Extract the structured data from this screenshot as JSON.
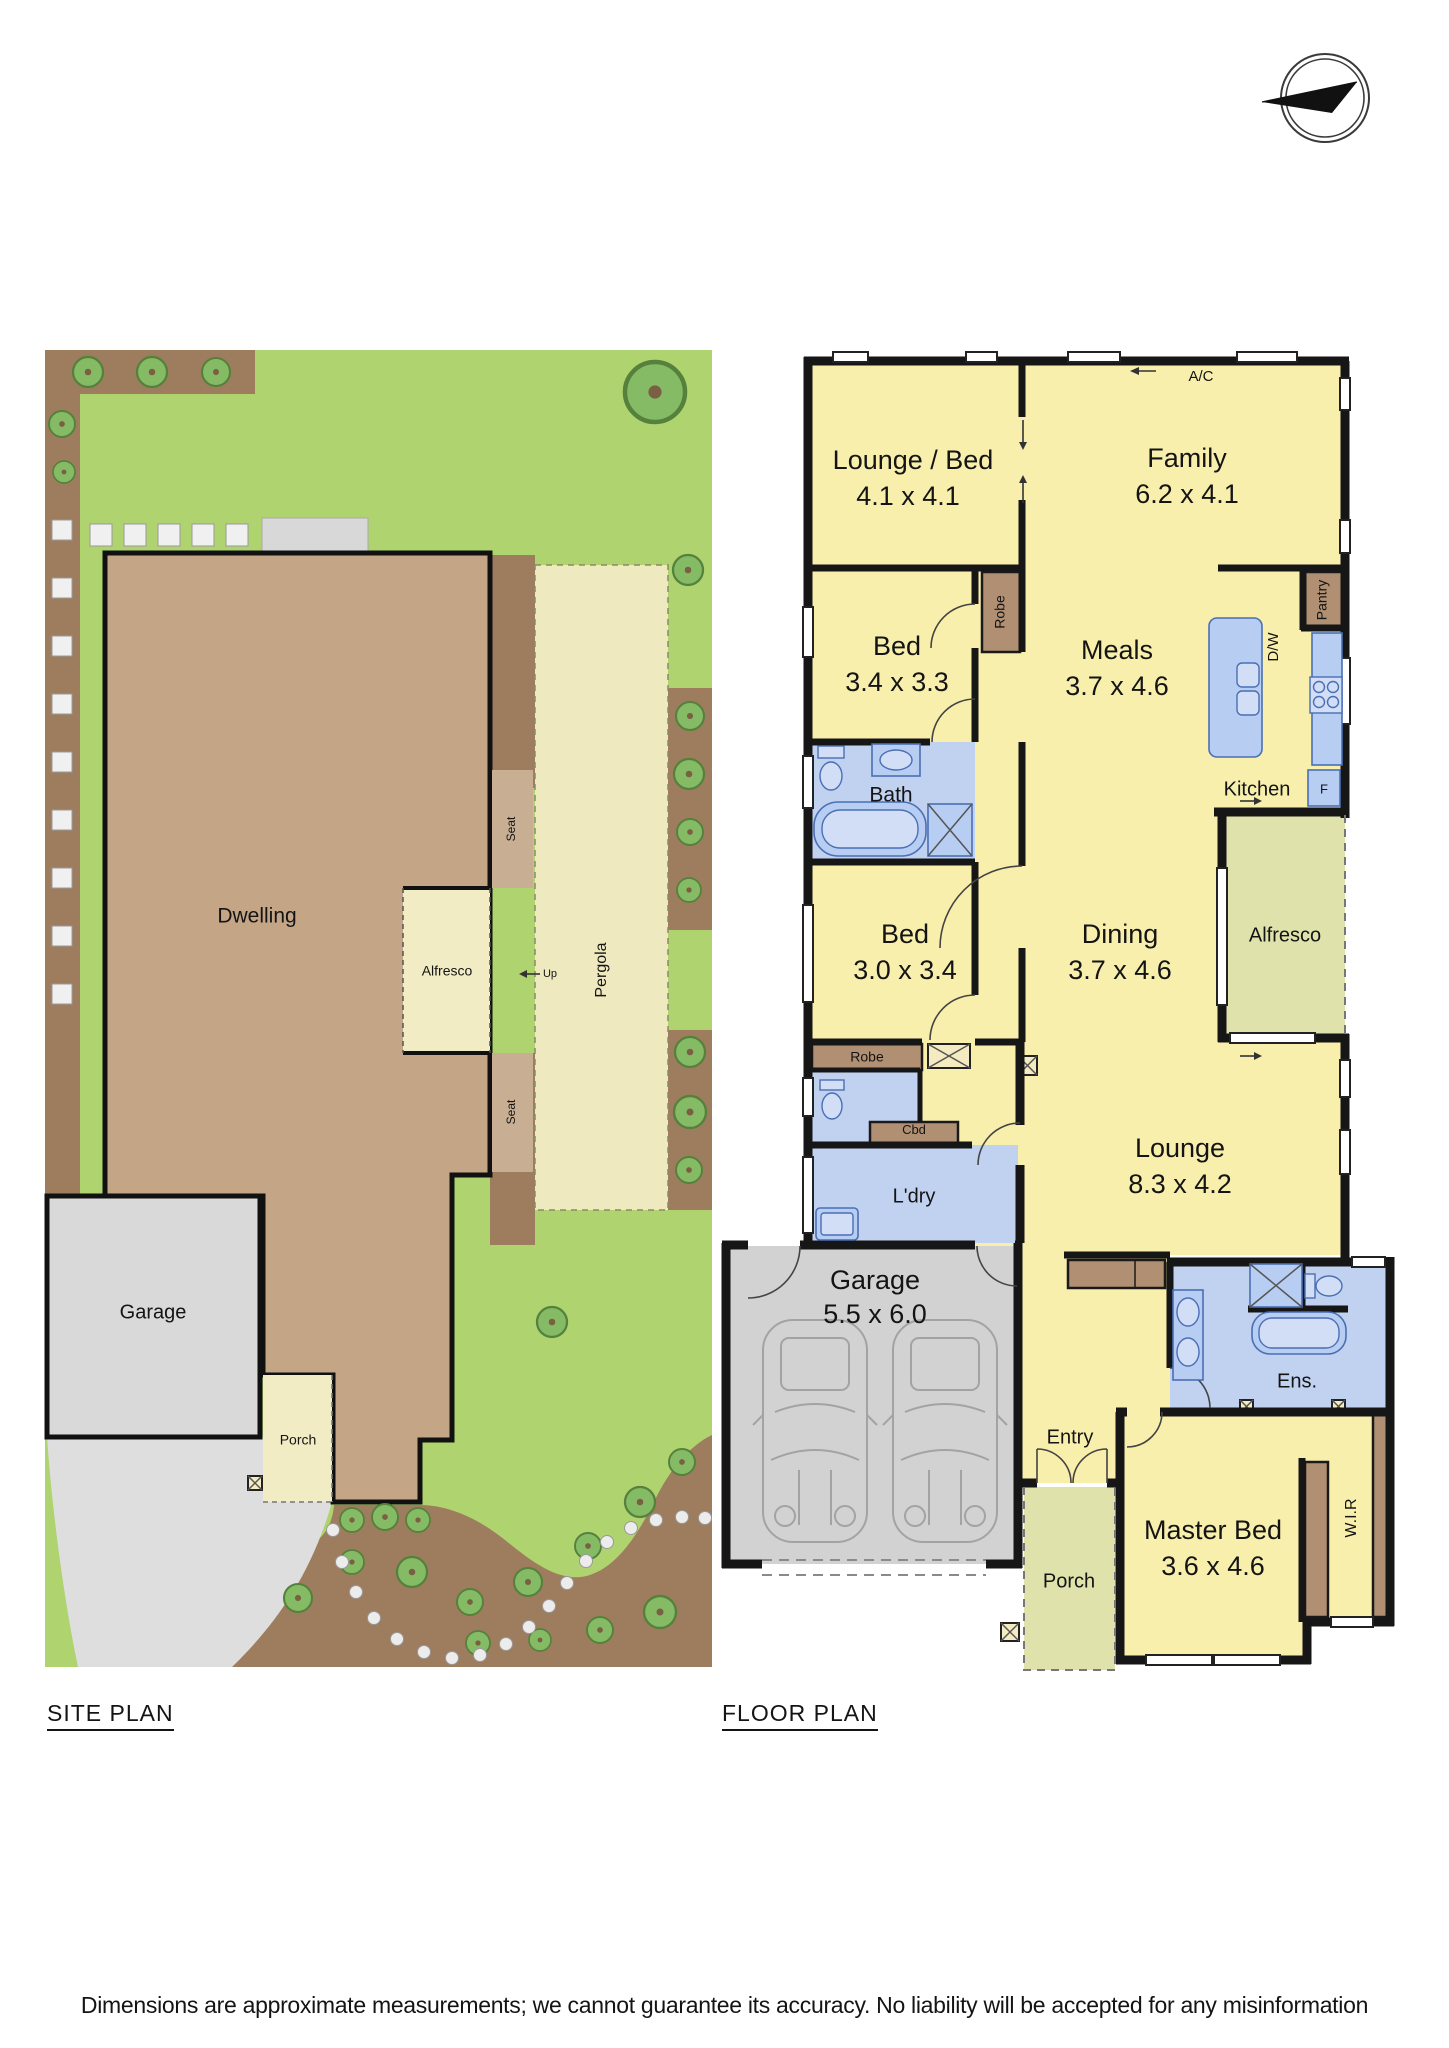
{
  "titles": {
    "site_plan": "SITE PLAN",
    "floor_plan": "FLOOR PLAN"
  },
  "disclaimer": "Dimensions are approximate measurements; we cannot guarantee its accuracy. No liability will be accepted for any misinformation",
  "site_plan": {
    "labels": {
      "dwelling": "Dwelling",
      "alfresco": "Alfresco",
      "pergola": "Pergola",
      "seat_top": "Seat",
      "seat_bottom": "Seat",
      "up": "Up",
      "garage": "Garage",
      "porch": "Porch"
    }
  },
  "floor_plan": {
    "rooms": {
      "lounge_bed": {
        "name": "Lounge / Bed",
        "dims": "4.1 x 4.1"
      },
      "family": {
        "name": "Family",
        "dims": "6.2 x 4.1"
      },
      "bed_2": {
        "name": "Bed",
        "dims": "3.4 x 3.3"
      },
      "meals": {
        "name": "Meals",
        "dims": "3.7 x 4.6"
      },
      "bath": {
        "name": "Bath"
      },
      "bed_3": {
        "name": "Bed",
        "dims": "3.0 x 3.4"
      },
      "dining": {
        "name": "Dining",
        "dims": "3.7 x 4.6"
      },
      "kitchen": {
        "name": "Kitchen"
      },
      "alfresco": {
        "name": "Alfresco"
      },
      "lounge": {
        "name": "Lounge",
        "dims": "8.3 x 4.2"
      },
      "laundry": {
        "name": "L'dry"
      },
      "garage": {
        "name": "Garage",
        "dims": "5.5 x 6.0"
      },
      "ensuite": {
        "name": "Ens."
      },
      "entry": {
        "name": "Entry"
      },
      "porch": {
        "name": "Porch"
      },
      "master_bed": {
        "name": "Master Bed",
        "dims": "3.6 x 4.6"
      },
      "wir": {
        "name": "W.I.R"
      }
    },
    "fixtures": {
      "ac": "A/C",
      "pantry": "Pantry",
      "dishwasher": "D/W",
      "fridge": "F",
      "robe_1": "Robe",
      "robe_2": "Robe",
      "cupboard": "Cbd"
    }
  },
  "colors": {
    "room_yellow": "#f9efad",
    "wet_blue": "#c1d1f0",
    "robe_brown": "#b08f72",
    "alfresco_olive": "#dfe3ab",
    "garage_grey": "#d2d2d2",
    "wall_black": "#161616",
    "lawn_green": "#aed36f",
    "tree_green": "#86bb66",
    "garden_brown": "#9d7d5d",
    "seat_tan": "#c8ae92",
    "dwelling_tan": "#c4a687",
    "pergola_cream": "#efe9c0",
    "driveway_grey": "#dedede"
  }
}
